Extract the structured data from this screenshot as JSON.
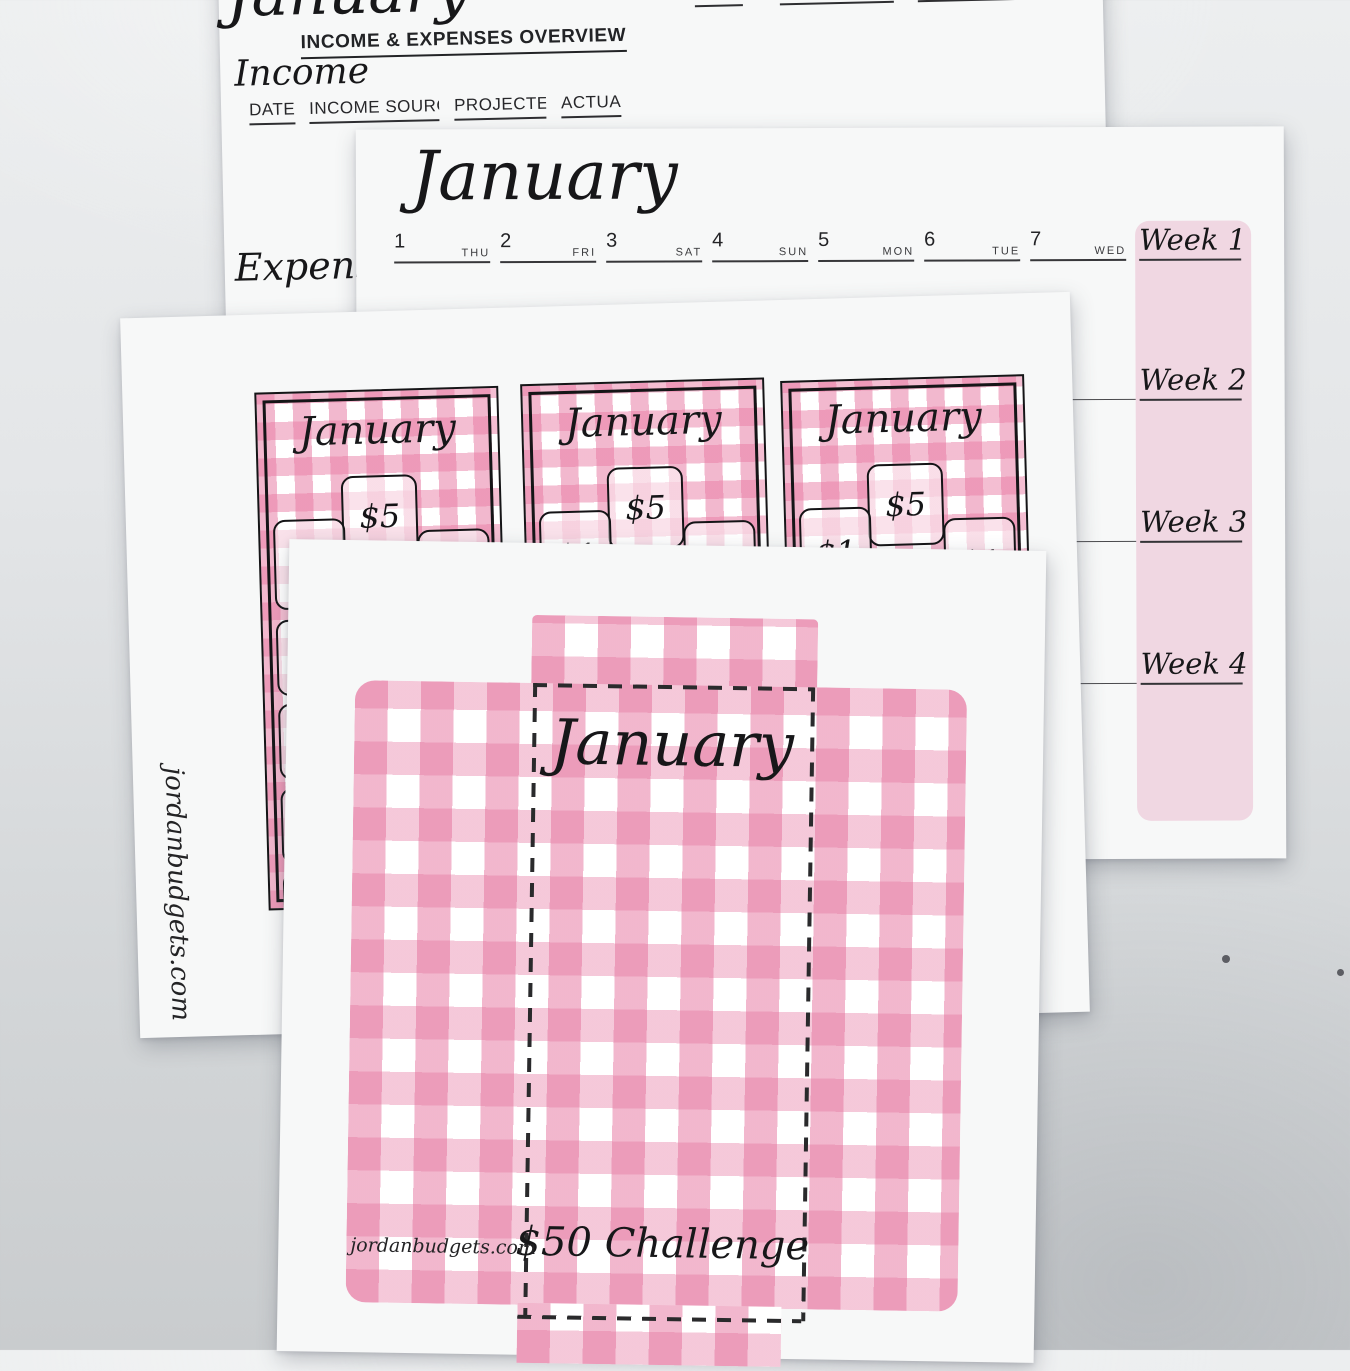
{
  "overview_sheet": {
    "cropped_month_title": "January",
    "heading": "INCOME & EXPENSES OVERVIEW",
    "expense_columns": [
      "DATE",
      "BILL",
      "PROJECTED",
      "ACTUAL"
    ],
    "income_label": "Income",
    "income_columns": [
      "DATE",
      "INCOME SOURCE",
      "PROJECTED",
      "ACTUAL"
    ],
    "expense_label": "Expense"
  },
  "calendar_sheet": {
    "month_title": "January",
    "days": [
      {
        "num": "1",
        "abbr": "THU"
      },
      {
        "num": "2",
        "abbr": "FRI"
      },
      {
        "num": "3",
        "abbr": "SAT"
      },
      {
        "num": "4",
        "abbr": "SUN"
      },
      {
        "num": "5",
        "abbr": "MON"
      },
      {
        "num": "6",
        "abbr": "TUE"
      },
      {
        "num": "7",
        "abbr": "WED"
      }
    ],
    "week_labels": [
      "Week 1",
      "Week 2",
      "Week 3",
      "Week 4"
    ],
    "week_column_color": "#f0d7e2"
  },
  "cards_sheet": {
    "watermark": "jordanbudgets.com",
    "cards": [
      {
        "month": "January",
        "amount_top": "$5",
        "amount_left": "$1",
        "amount_right": "$1",
        "amount_center": "$1"
      },
      {
        "month": "January",
        "amount_top": "$5",
        "amount_left": "$1",
        "amount_right": "$1",
        "amount_center": "$1"
      },
      {
        "month": "January",
        "amount_top": "$5",
        "amount_left": "$1",
        "amount_right": "$1",
        "amount_center": "$1"
      }
    ],
    "partial_amounts": [
      "$",
      "$",
      "$",
      "$"
    ]
  },
  "envelope_sheet": {
    "month_title": "January",
    "challenge_label": "$50 Challenge",
    "watermark": "jordanbudgets.com"
  },
  "colors": {
    "gingham_pink": "#e87da5",
    "week_column_pink": "#f0d7e2",
    "paper_white": "#f7f8f8",
    "ink": "#1d1d1f",
    "backdrop_top": "#eceeef",
    "backdrop_bottom": "#c9ccce"
  }
}
